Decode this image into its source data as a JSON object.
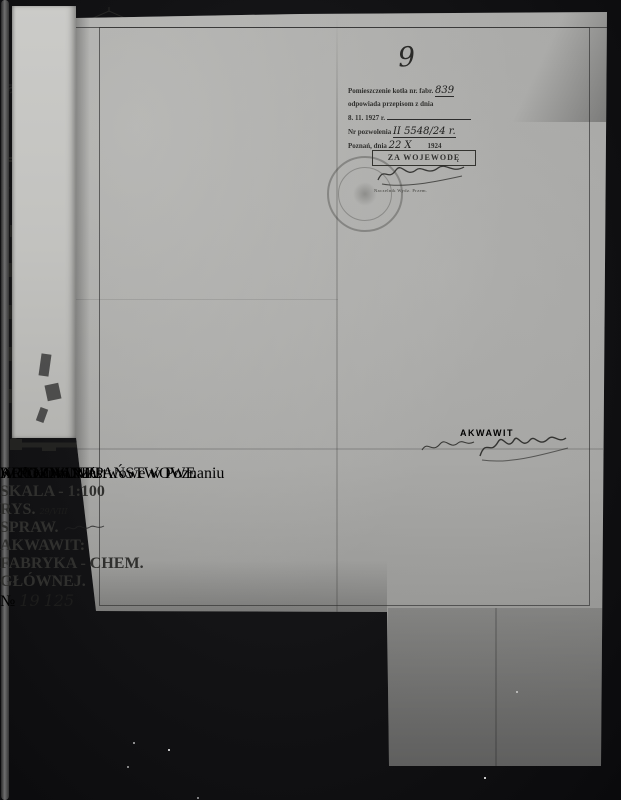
{
  "page_number": "9",
  "watermark": {
    "line1": "ARCHIWUM PAŃSTWOWE",
    "line2": "W POZNANIU",
    "accent_color": "#c65c66"
  },
  "footer": {
    "label": "Archiwum Państwowe w Poznaniu"
  },
  "approval_note": {
    "line1": "Pomieszczenie kotła nr. fabr.",
    "line1_hand": "839",
    "line2": "odpowiada przepisom z dnia",
    "line3": "8. 11. 1927 r.",
    "line4": "Nr pozwolenia",
    "line4_hand": "II 5548/24 r.",
    "line5": "Poznań, dnia",
    "line5_hand": "22 X",
    "line5_year": "1924"
  },
  "voivode_stamp": {
    "title": "ZA WOJEWODĘ",
    "subline": "Naczelnik Wydz. Przem."
  },
  "akwawit_stamp": {
    "title": "AKWAWIT"
  },
  "title_block": {
    "title": "KOTŁOWNIA.",
    "scale_label": "SKALA - 1:100",
    "rys_label": "RYS.",
    "rys_hand": "29/VIII",
    "spraw_label": "SPRAW.",
    "company_line1": "AKWAWIT:",
    "company_line2": "FABRYKA - CHEM.",
    "company_line3": "GŁÓWNEJ.",
    "no_label": "№",
    "no_top": "19",
    "no_bottom": "125"
  },
  "plan": {
    "label_lokomobila": "Lokomobila",
    "label_piece": "Piece",
    "dim_bottom": "14,60",
    "dim_left": "13,40",
    "dim_right_upper": "5,410",
    "dim_right_lower": "5,150",
    "dim_top": "4,20+2,00"
  },
  "section_left": {
    "dim_height": "8,500",
    "dim_roof": "3,300",
    "dim_boiler_width": "1,985",
    "dim_boiler_height": "2,380"
  },
  "section_right": {
    "dim_a": "0,980",
    "dim_b": "5,410",
    "dim_c": "5,150",
    "dim_boiler_height": "3,480"
  }
}
